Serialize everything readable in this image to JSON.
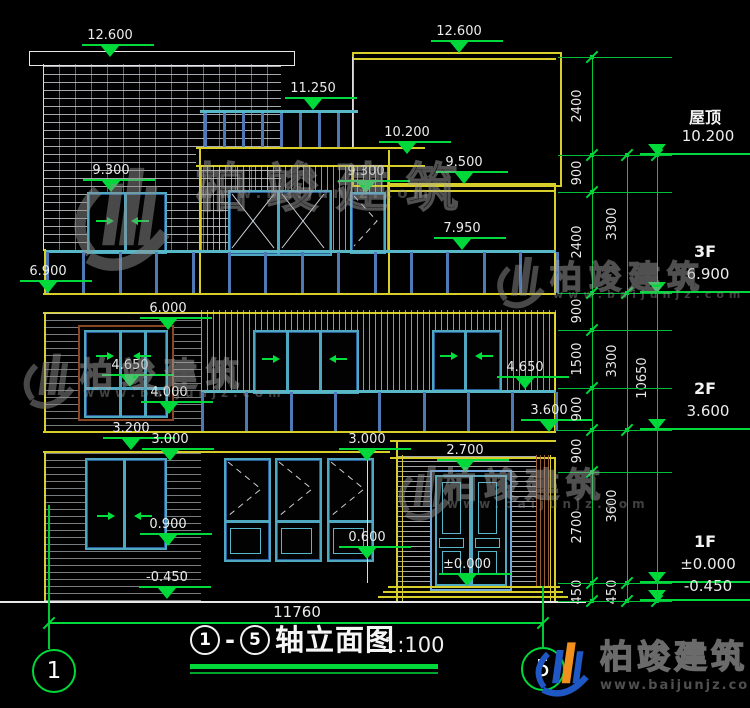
{
  "title_block": {
    "circle_a": "1",
    "circle_b": "5",
    "dash": "-",
    "title_text": "轴立面图",
    "scale": "1:100",
    "axis_left": "1",
    "axis_right": "5"
  },
  "bottom_dim": "11760",
  "watermark": {
    "name": "柏竣建筑",
    "url": "www.baijunjz.com"
  },
  "brand": {
    "name": "柏竣建筑",
    "url": "www.baijunjz.com"
  },
  "right_levels": [
    {
      "floor": "屋顶",
      "elev": "10.200",
      "y": 155
    },
    {
      "floor": "3F",
      "elev": "6.900",
      "y": 293
    },
    {
      "floor": "2F",
      "elev": "3.600",
      "y": 430
    },
    {
      "floor": "1F",
      "elev": "±0.000",
      "y": 583
    },
    {
      "floor": "",
      "elev": "-0.450",
      "y": 601
    }
  ],
  "elevation_markers": [
    {
      "label": "12.600",
      "x": 110,
      "y": 57
    },
    {
      "label": "12.600",
      "x": 459,
      "y": 53
    },
    {
      "label": "11.250",
      "x": 313,
      "y": 110
    },
    {
      "label": "10.200",
      "x": 407,
      "y": 154
    },
    {
      "label": "9.500",
      "x": 464,
      "y": 184
    },
    {
      "label": "9.300",
      "x": 111,
      "y": 192
    },
    {
      "label": "9.300",
      "x": 366,
      "y": 193
    },
    {
      "label": "7.950",
      "x": 462,
      "y": 250
    },
    {
      "label": "6.900",
      "x": 48,
      "y": 293
    },
    {
      "label": "6.000",
      "x": 168,
      "y": 330
    },
    {
      "label": "4.650",
      "x": 130,
      "y": 387
    },
    {
      "label": "4.650",
      "x": 525,
      "y": 389
    },
    {
      "label": "4.000",
      "x": 169,
      "y": 414
    },
    {
      "label": "3.200",
      "x": 131,
      "y": 450
    },
    {
      "label": "3.000",
      "x": 170,
      "y": 461
    },
    {
      "label": "3.000",
      "x": 367,
      "y": 461
    },
    {
      "label": "3.600",
      "x": 549,
      "y": 432
    },
    {
      "label": "2.700",
      "x": 465,
      "y": 472
    },
    {
      "label": "0.900",
      "x": 168,
      "y": 546
    },
    {
      "label": "0.600",
      "x": 367,
      "y": 559
    },
    {
      "label": "±0.000",
      "x": 467,
      "y": 586
    },
    {
      "label": "-0.450",
      "x": 167,
      "y": 599
    }
  ],
  "dim_chains": [
    {
      "x": 592,
      "ticks": [
        57,
        155,
        192,
        293,
        330,
        388,
        430,
        472,
        583,
        601
      ],
      "labels": [
        [
          "2400",
          106
        ],
        [
          "900",
          173
        ],
        [
          "2400",
          242
        ],
        [
          "900",
          311
        ],
        [
          "1500",
          359
        ],
        [
          "900",
          409
        ],
        [
          "900",
          451
        ],
        [
          "2700",
          527
        ],
        [
          "450",
          592
        ]
      ]
    },
    {
      "x": 627,
      "ticks": [
        155,
        293,
        430,
        583,
        601
      ],
      "labels": [
        [
          "3300",
          224
        ],
        [
          "3300",
          361
        ],
        [
          "3600",
          506
        ],
        [
          "450",
          592
        ]
      ]
    },
    {
      "x": 657,
      "ticks": [
        155,
        601
      ],
      "labels": [
        [
          "10650",
          378
        ]
      ]
    }
  ],
  "extension_levels": [
    57,
    155,
    192,
    293,
    330,
    388,
    430,
    472,
    583,
    601
  ],
  "watermarks": [
    {
      "gx": 64,
      "gy": 150,
      "gs": 112,
      "tx": 196,
      "ty": 146,
      "fs": 52,
      "ls": 18,
      "ux": 200,
      "uy": 184,
      "ufs": 15
    },
    {
      "gx": 18,
      "gy": 344,
      "gs": 60,
      "tx": 80,
      "ty": 348,
      "fs": 33,
      "ls": 9,
      "ux": 83,
      "uy": 386,
      "ufs": 12
    },
    {
      "gx": 492,
      "gy": 248,
      "gs": 56,
      "tx": 550,
      "ty": 252,
      "fs": 32,
      "ls": 7,
      "ux": 553,
      "uy": 288,
      "ufs": 11
    },
    {
      "gx": 393,
      "gy": 456,
      "gs": 60,
      "tx": 443,
      "ty": 458,
      "fs": 34,
      "ls": 7,
      "ux": 447,
      "uy": 497,
      "ufs": 12
    }
  ]
}
